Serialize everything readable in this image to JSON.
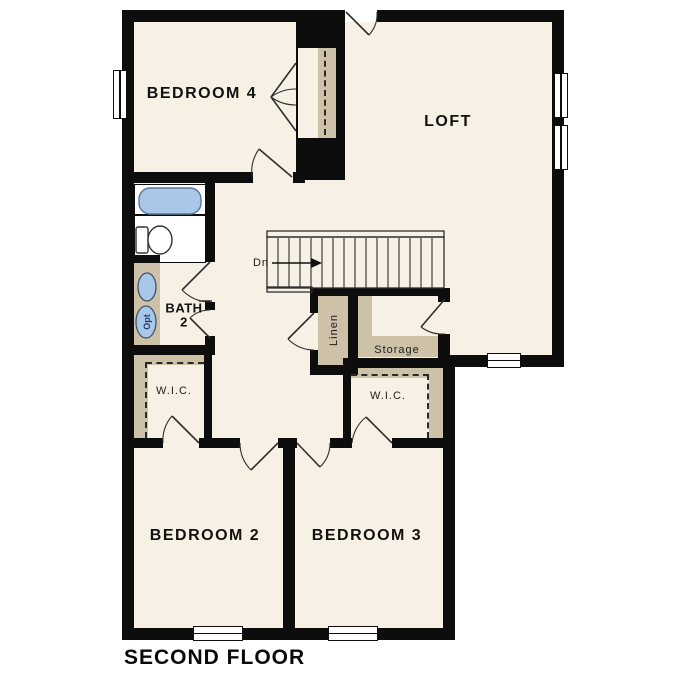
{
  "plan": {
    "title": "SECOND FLOOR",
    "rooms": {
      "bedroom4": "BEDROOM 4",
      "loft": "LOFT",
      "bedroom2": "BEDROOM 2",
      "bedroom3": "BEDROOM 3",
      "bath2": "BATH\n2",
      "wic_left": "W.I.C.",
      "wic_right": "W.I.C.",
      "linen": "Linen",
      "storage": "Storage"
    },
    "stairs": {
      "direction_label": "Dn"
    },
    "fixtures": {
      "optional_sink_label": "Opt"
    },
    "colors": {
      "wall": "#0d0d0d",
      "floor": "#f7f0e4",
      "shelf": "#cdc1a8",
      "blue": "#a9c8e9",
      "outside": "#ffffff"
    }
  }
}
